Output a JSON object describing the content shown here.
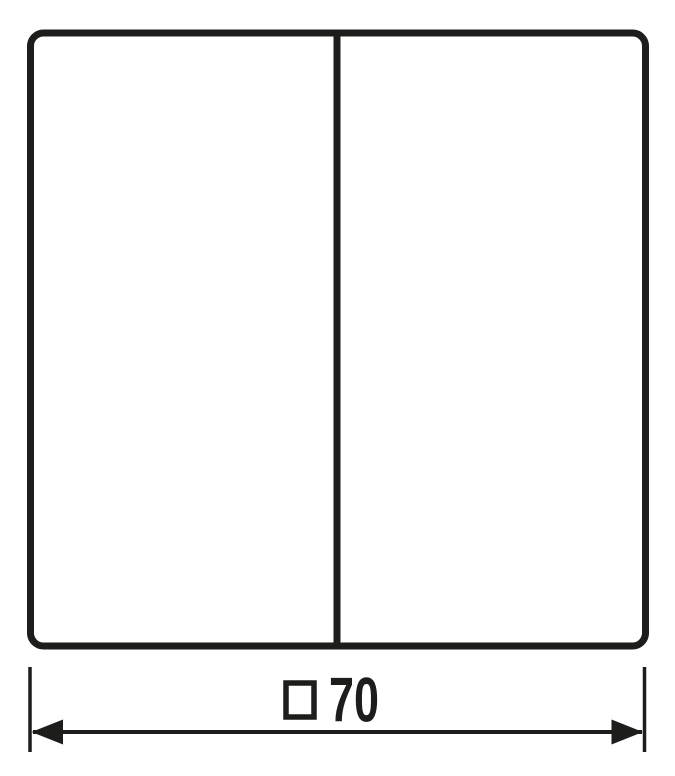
{
  "colors": {
    "line": "#1d1d1b",
    "background": "#ffffff"
  },
  "dimension": {
    "symbol": "□",
    "value": "70",
    "full_label": "□70"
  }
}
